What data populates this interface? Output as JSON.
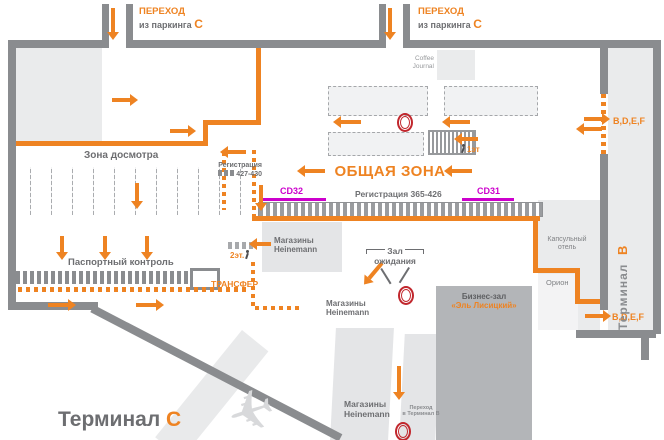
{
  "colors": {
    "orange": "#EE8322",
    "wall": "#8A8C8F",
    "magenta": "#CC00CC",
    "red": "#C1272D",
    "text_gray": "#6D6E71"
  },
  "parking_passages": [
    {
      "title": "ПЕРЕХОД",
      "subtitle": "из паркинга",
      "terminal": "C"
    },
    {
      "title": "ПЕРЕХОД",
      "subtitle": "из паркинга",
      "terminal": "C"
    }
  ],
  "terminals": {
    "b_gallery": {
      "name": "Терминал",
      "letter": "B"
    },
    "c_title": {
      "name": "Терминал",
      "letter": "C"
    },
    "bdef_top": "B,D,E,F",
    "bdef_bottom": "B,D,E,F"
  },
  "zones": {
    "common": "ОБЩАЯ ЗОНА",
    "security": "Зона досмотра",
    "passport": "Паспортный контроль",
    "waiting_l1": "Зал",
    "waiting_l2": "ожидания",
    "transfer": "ТРАНСФЕР",
    "floor1": "1эт",
    "floor2": "2эт."
  },
  "checkin": {
    "main": "Регистрация 365-426",
    "aux_l1": "Регистрация",
    "aux_l2": "427-430",
    "cd32": "CD32",
    "cd31": "CD31"
  },
  "shops": {
    "heinemann_l1": "Магазины",
    "heinemann_l2": "Heinemann",
    "coffee_l1": "Coffee",
    "coffee_l2": "Journal",
    "orion": "Орион",
    "capsule_l1": "Капсульный",
    "capsule_l2": "отель",
    "lounge_l1": "Бизнес-зал",
    "lounge_l2": "«Эль Лисицкий»"
  },
  "bottom_passage": {
    "l1": "Переход",
    "l2": "в Терминал B"
  },
  "icons": [
    "down-arrow",
    "up-arrow",
    "left-arrow",
    "right-arrow",
    "info-point",
    "escalator",
    "elevator",
    "stairs",
    "person",
    "plane"
  ]
}
